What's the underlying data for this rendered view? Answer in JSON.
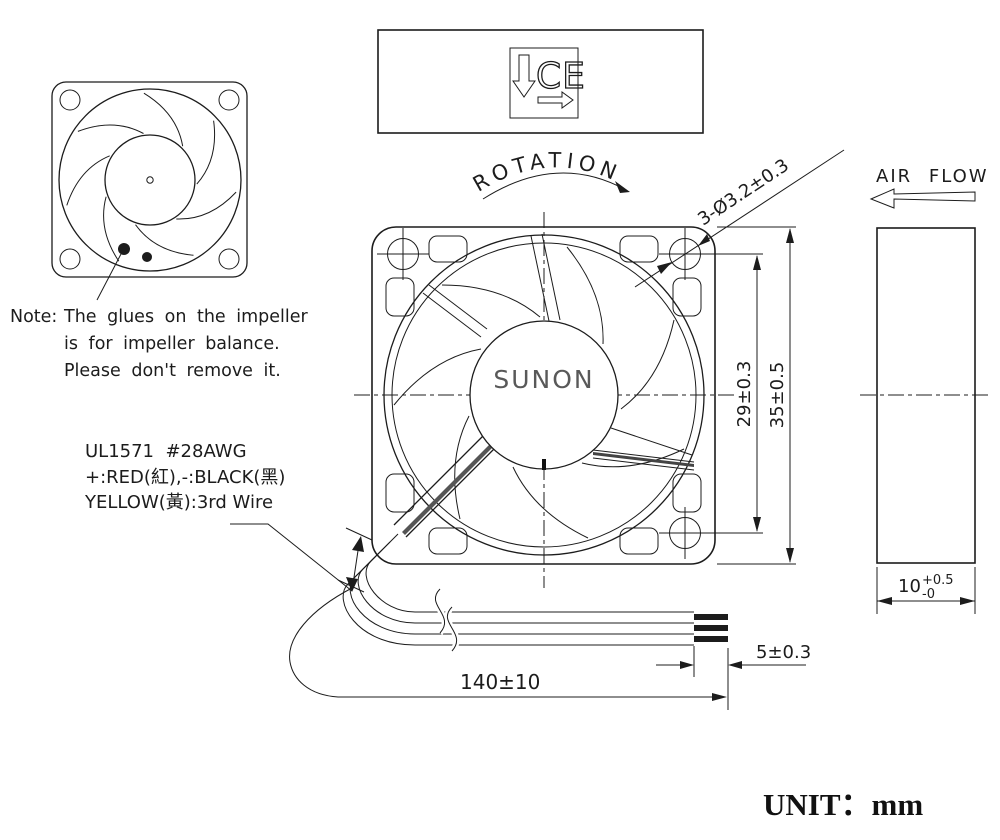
{
  "note": {
    "label": "Note:",
    "line1": "The glues on the impeller",
    "line2": "is for impeller balance.",
    "line3": "Please don't remove it."
  },
  "wire_spec": {
    "line1": "UL1571  #28AWG",
    "line2": "+:RED(紅),-:BLACK(黑)",
    "line3": "YELLOW(黃):3rd Wire"
  },
  "labels": {
    "rotation": "ROTATION",
    "air_flow": "AIR FLOW",
    "brand": "SUNON",
    "ce": "CE",
    "unit": "UNIT：mm"
  },
  "dimensions": {
    "mounting_holes": "3-Ø3.2±0.3",
    "hole_pitch": "29±0.3",
    "frame_size": "35±0.5",
    "thickness_value": "10",
    "thickness_tol_upper": "+0.5",
    "thickness_tol_lower": "-0",
    "strip_length": "5±0.3",
    "lead_length": "140±10"
  },
  "colors": {
    "line": "#1c1c1c",
    "brand_text": "#595959",
    "background": "#ffffff"
  }
}
